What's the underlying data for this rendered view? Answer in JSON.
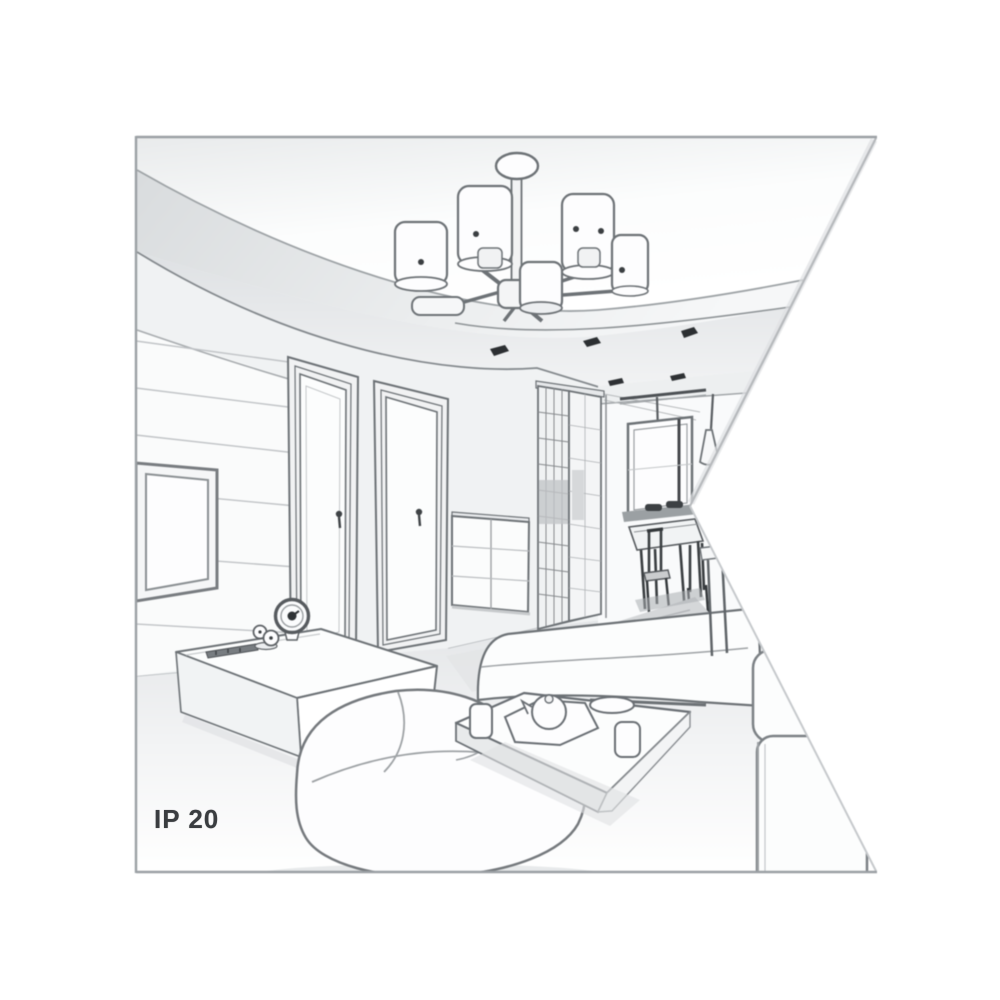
{
  "meta": {
    "description": "Grayscale perspective line-art illustration of a living room interior, used as a lamp product context image. Right edge of the drawing is cut by a white wedge (notch) pointing into the room's vanishing point.",
    "style": "pencil / vector sketch, monochrome"
  },
  "badge": {
    "label": "IP 20"
  },
  "palette": {
    "background": "#ffffff",
    "frame_border": "#9ba0a4",
    "sketch_line": "#6d7276",
    "sketch_line_dark": "#3b3f42",
    "fill_white": "#fdfdfe",
    "fill_light": "#f2f3f4",
    "fill_mid": "#e4e6e8",
    "fill_shadow": "#cfd2d4",
    "accent_dark": "#2e3134"
  },
  "scene": {
    "objects": [
      "ceiling chandelier with cylindrical shades",
      "recessed ceiling with dark spotlights",
      "left wall with horizontal paneling and wall-mounted TV",
      "two interior doors with handles",
      "chest of drawers",
      "slatted wardrobe sliding doors",
      "hallway opening to dining area",
      "window with dark sill",
      "two cone pendant lights over dining table",
      "dining table with dark chairs",
      "TV console with clock, figurine and remote",
      "white bench sofa",
      "white corner sofa (foreground)",
      "partially visible right sofa",
      "white coffee table with cups, tray, teapot and dish"
    ]
  }
}
